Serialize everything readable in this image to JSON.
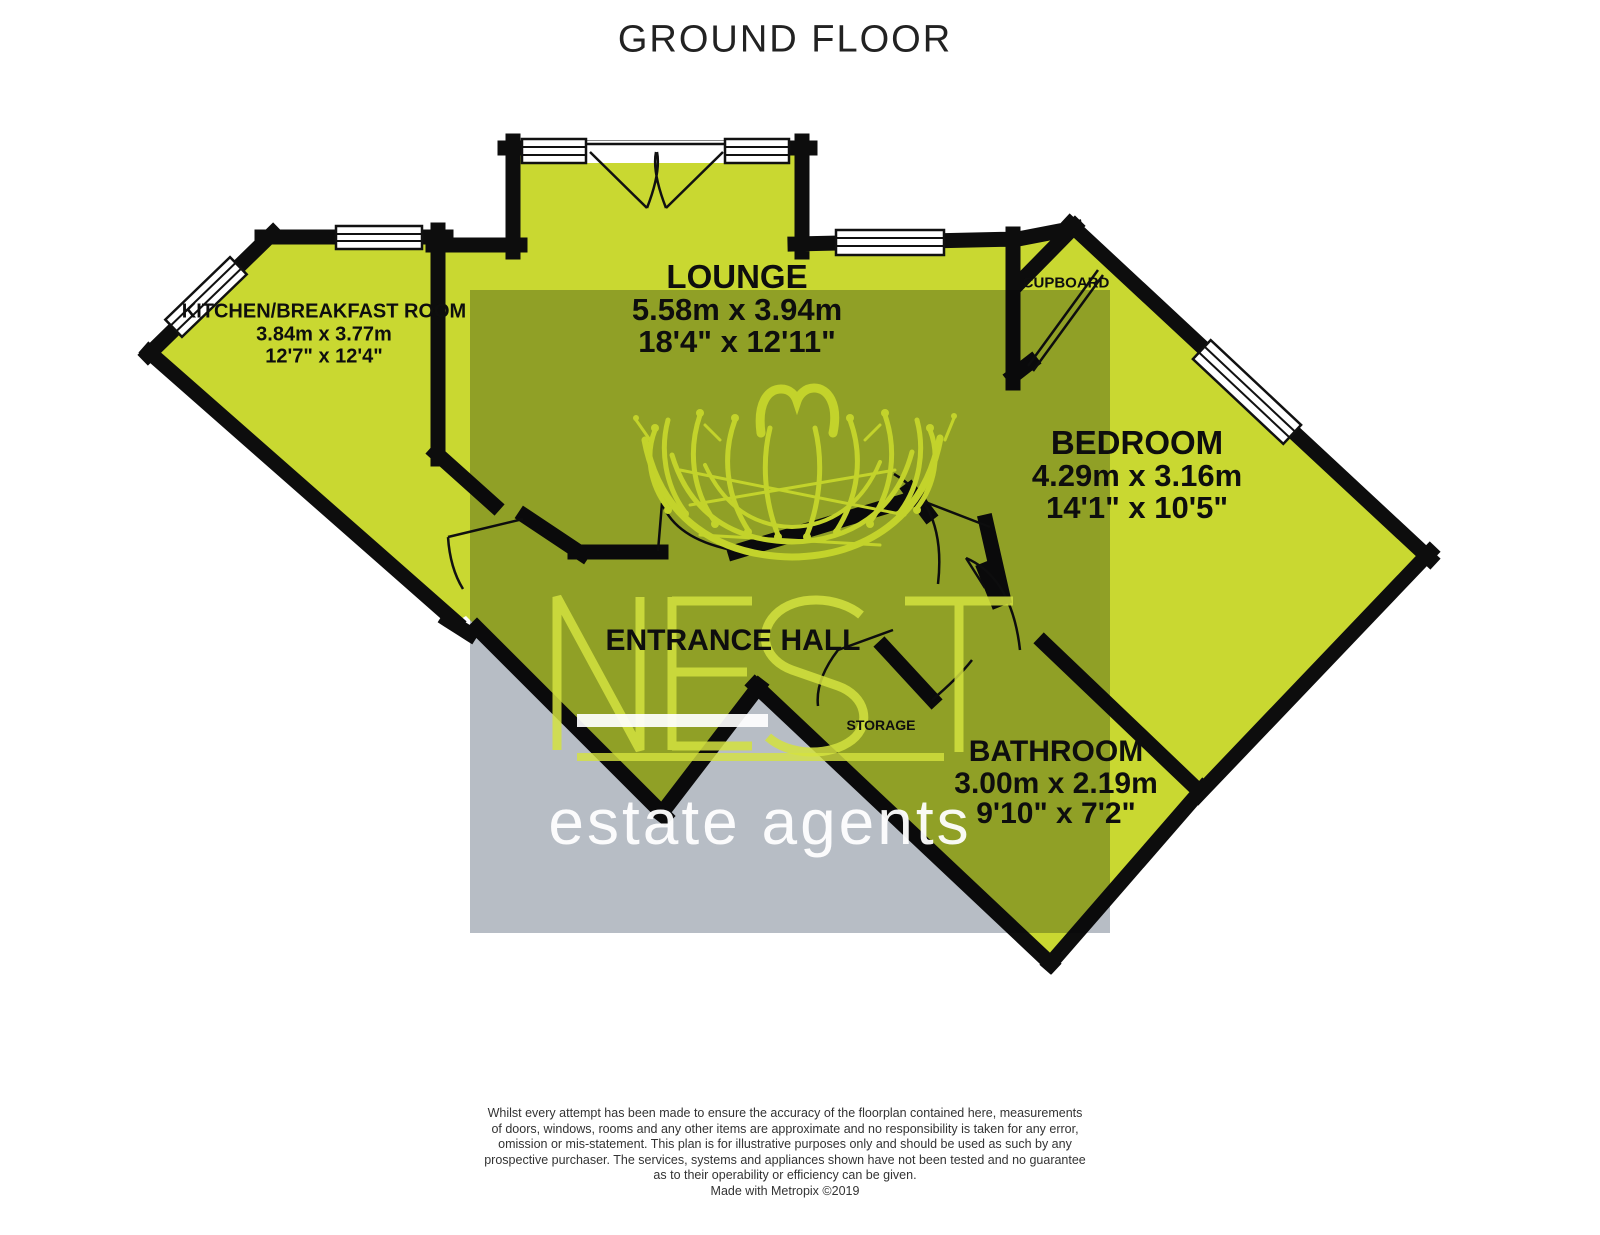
{
  "title": "GROUND FLOOR",
  "rooms": {
    "lounge": {
      "name": "LOUNGE",
      "metric": "5.58m x 3.94m",
      "imperial": "18'4\" x 12'11\""
    },
    "kitchen": {
      "name": "KITCHEN/BREAKFAST ROOM",
      "metric": "3.84m x 3.77m",
      "imperial": "12'7\" x 12'4\""
    },
    "bedroom": {
      "name": "BEDROOM",
      "metric": "4.29m x 3.16m",
      "imperial": "14'1\" x 10'5\""
    },
    "bathroom": {
      "name": "BATHROOM",
      "metric": "3.00m x 2.19m",
      "imperial": "9'10\" x 7'2\""
    },
    "entrance_hall": {
      "name": "ENTRANCE HALL"
    },
    "cupboard": {
      "name": "CUPBOARD"
    },
    "storage": {
      "name": "STORAGE"
    }
  },
  "watermark": {
    "brand": "NEST",
    "tagline": "estate agents"
  },
  "disclaimer": {
    "lines": [
      "Whilst every attempt has been made to ensure the accuracy of the floorplan contained here, measurements",
      "of doors, windows, rooms and any other items are approximate and no responsibility is taken for any error,",
      "omission or mis-statement. This plan is for illustrative purposes only and should be used as such by any",
      "prospective purchaser. The services, systems and appliances shown have not been tested and no guarantee",
      "as to their operability or efficiency can be given."
    ],
    "credit": "Made with Metropix ©2019"
  },
  "colors": {
    "floor": "#c9d831",
    "watermark_gray": "#b7bdc5",
    "wall": "#0d0d0d",
    "logoyellow": "#d4e23f"
  }
}
